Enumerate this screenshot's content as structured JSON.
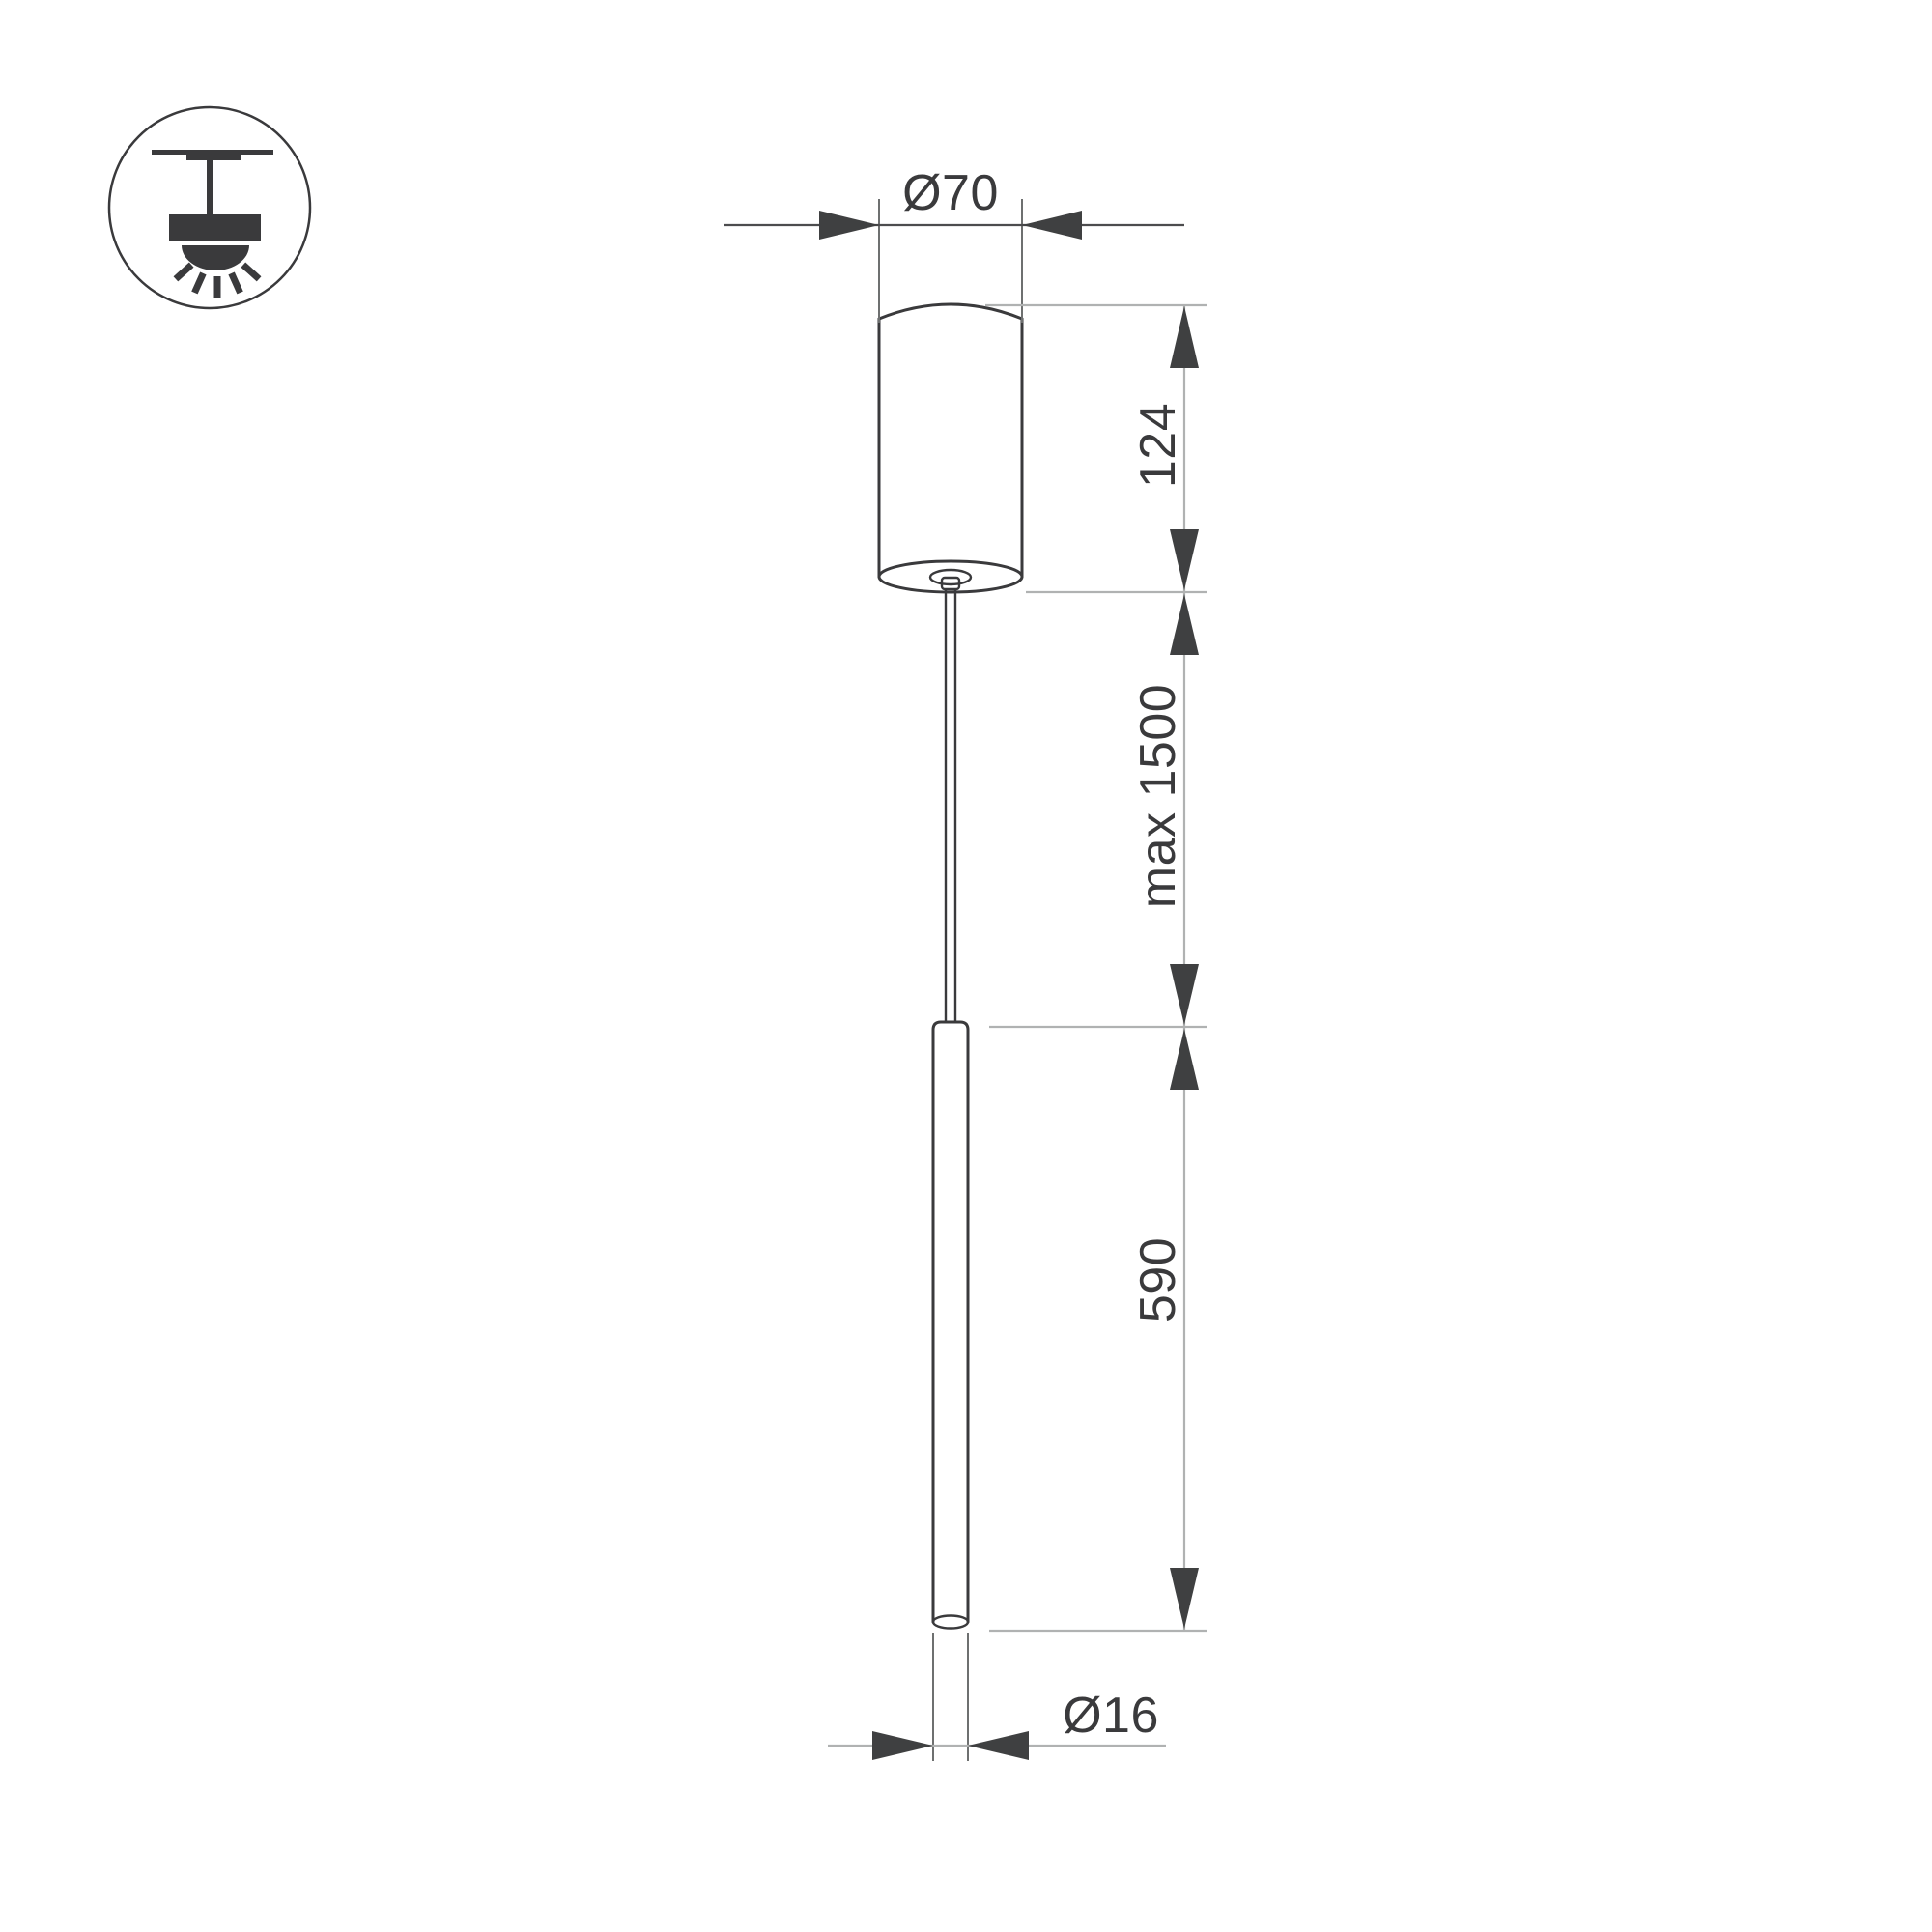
{
  "page": {
    "background": "#ffffff"
  },
  "icon": {
    "name": "ceiling-pendant-mount-icon",
    "description": "surface ceiling mount pendant luminaire symbol"
  },
  "drawing": {
    "view": "pendant luminaire side elevation",
    "labels": {
      "canopy_diameter": "Ø70",
      "canopy_height": "124",
      "suspension_length": "max 1500",
      "tube_length": "590",
      "tube_diameter": "Ø16"
    },
    "colors": {
      "outline": "#3a3a3c",
      "dimension_line_dark": "#4c4c4e",
      "dimension_line_light": "#b0b2b2",
      "extension_line_medium": "#6e7070",
      "arrow": "#3f4041",
      "text": "#3a3a3c",
      "background": "#ffffff"
    }
  }
}
